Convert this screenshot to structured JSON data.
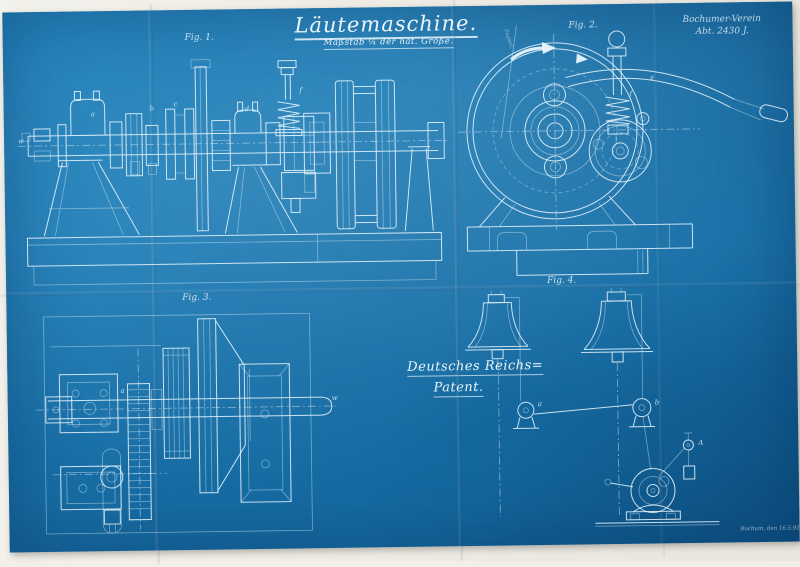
{
  "document": {
    "title": "Läutemaschine.",
    "scale_note": "Maßstab ¼ der nat. Größe.",
    "company": {
      "line1": "Bochumer-Verein",
      "line2": "Abt. 2430 J."
    },
    "patent": {
      "line1": "Deutsches Reichs=",
      "line2": "Patent."
    },
    "date_note": "Bochum, den 16.5.91.",
    "figures": {
      "fig1": "Fig. 1.",
      "fig2": "Fig. 2.",
      "fig3": "Fig. 3.",
      "fig4": "Fig. 4."
    },
    "rope_label": "Zugseil.",
    "part_labels": {
      "w1": "w",
      "a1": "a",
      "b1": "b",
      "c1": "c",
      "d1": "d",
      "f1": "f",
      "f2": "f",
      "s2": "s",
      "a3": "a",
      "w3": "w",
      "a4": "a",
      "b4": "b",
      "A4": "A"
    },
    "colors": {
      "paper": "#f0eee7",
      "blueprint": "#1878b4",
      "line": "#e6f2fa"
    }
  }
}
